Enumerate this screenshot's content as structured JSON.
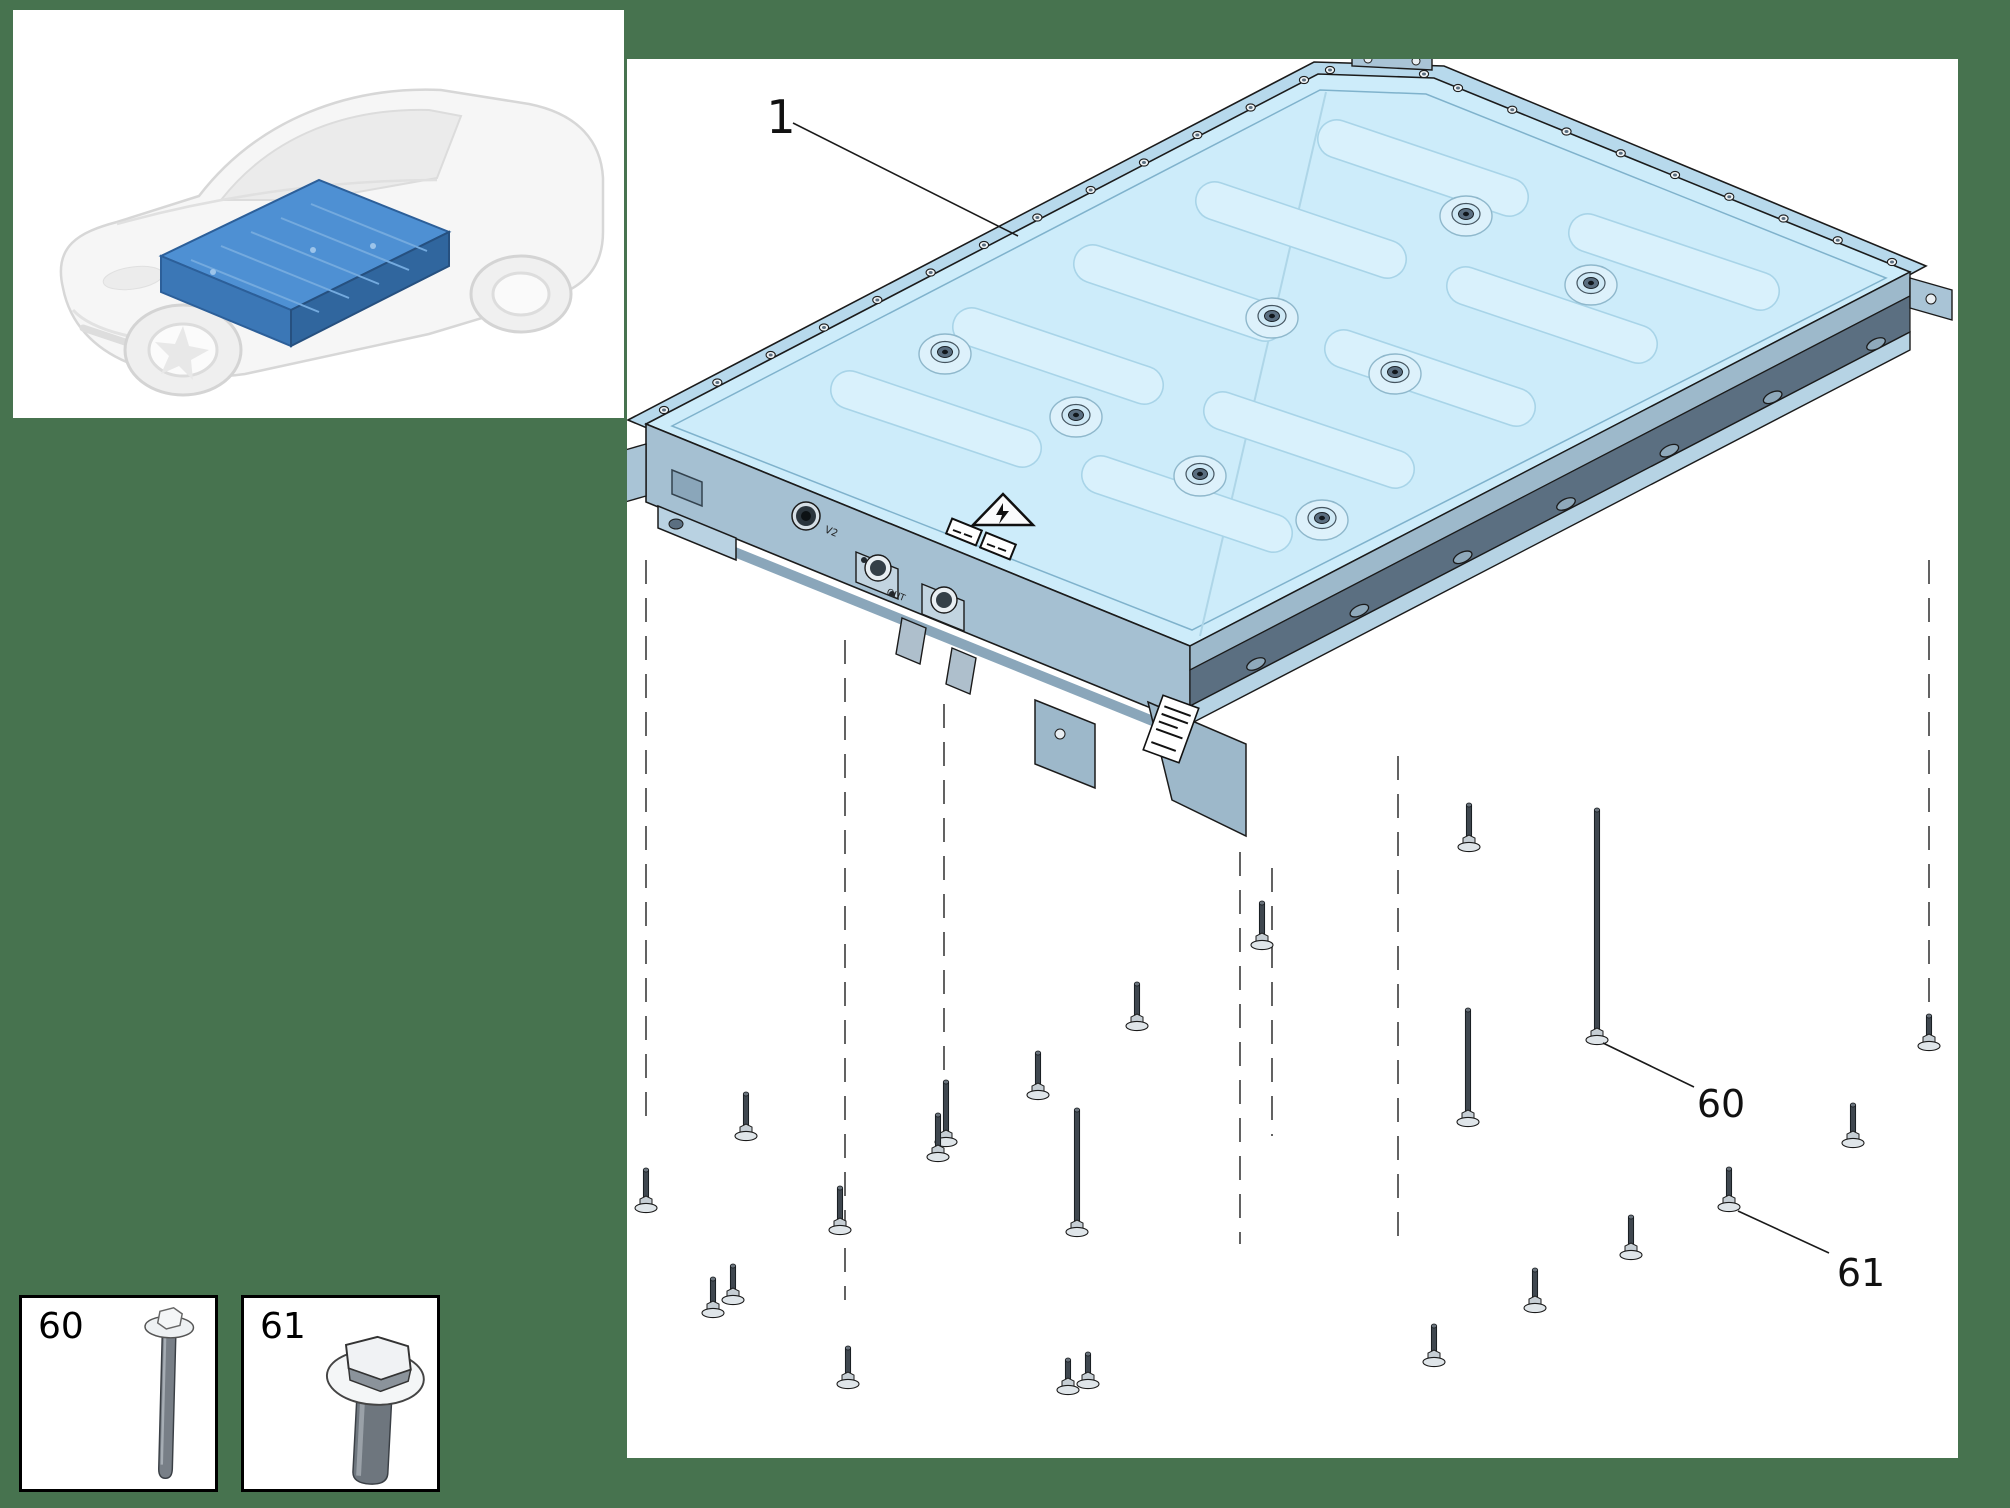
{
  "colors": {
    "background": "#47734f",
    "panel": "#ffffff",
    "pack_top": "#cdecfa",
    "pack_rim": "#b7d9ec",
    "pack_wall": "#a5c0d2",
    "pack_wall_right": "#9db9cb",
    "pack_dark_band": "#5b6f81",
    "pack_flange": "#b6d3e4",
    "outline": "#1b1b1b",
    "bolt_shaft": "#3f474f",
    "bolt_flange": "#dfe5e9",
    "dash": "#3c3c3c",
    "inset_battery_top": "#4e90d3",
    "inset_battery_left": "#3b77b6",
    "inset_battery_right": "#30669e",
    "car_line": "#d7d7d7",
    "car_fill": "#f6f6f6"
  },
  "inset": {
    "x": 13,
    "y": 10,
    "w": 611,
    "h": 408
  },
  "main_panel": {
    "x": 627,
    "y": 59,
    "w": 1331,
    "h": 1399
  },
  "pack_labels": {
    "port": "V2",
    "out": "OUT"
  },
  "callouts": [
    {
      "id": "1",
      "label": "1",
      "tx": 781,
      "ty": 133,
      "size": 46,
      "x1": 793,
      "y1": 123,
      "x2": 1018,
      "y2": 236
    },
    {
      "id": "60",
      "label": "60",
      "tx": 1721,
      "ty": 1117,
      "size": 38,
      "x1": 1603,
      "y1": 1043,
      "x2": 1694,
      "y2": 1087
    },
    {
      "id": "61",
      "label": "61",
      "tx": 1861,
      "ty": 1286,
      "size": 38,
      "x1": 1738,
      "y1": 1211,
      "x2": 1829,
      "y2": 1253
    }
  ],
  "dashed_lines": [
    {
      "x": 646,
      "y1": 560,
      "y2": 1120
    },
    {
      "x": 845,
      "y1": 640,
      "y2": 1300
    },
    {
      "x": 944,
      "y1": 704,
      "y2": 1082
    },
    {
      "x": 1240,
      "y1": 852,
      "y2": 1244
    },
    {
      "x": 1272,
      "y1": 868,
      "y2": 1136
    },
    {
      "x": 1398,
      "y1": 756,
      "y2": 1246
    },
    {
      "x": 1929,
      "y1": 560,
      "y2": 1034
    }
  ],
  "bolts": [
    {
      "x": 646,
      "y": 1208,
      "len": 38
    },
    {
      "x": 713,
      "y": 1313,
      "len": 34
    },
    {
      "x": 733,
      "y": 1300,
      "len": 34
    },
    {
      "x": 746,
      "y": 1136,
      "len": 42
    },
    {
      "x": 848,
      "y": 1384,
      "len": 36
    },
    {
      "x": 946,
      "y": 1142,
      "len": 60
    },
    {
      "x": 1077,
      "y": 1232,
      "len": 122
    },
    {
      "x": 1068,
      "y": 1390,
      "len": 30
    },
    {
      "x": 1088,
      "y": 1384,
      "len": 30
    },
    {
      "x": 1262,
      "y": 945,
      "len": 42
    },
    {
      "x": 1137,
      "y": 1026,
      "len": 42
    },
    {
      "x": 1038,
      "y": 1095,
      "len": 42
    },
    {
      "x": 938,
      "y": 1157,
      "len": 42
    },
    {
      "x": 840,
      "y": 1230,
      "len": 42
    },
    {
      "x": 1469,
      "y": 847,
      "len": 42
    },
    {
      "x": 1468,
      "y": 1122,
      "len": 112
    },
    {
      "x": 1597,
      "y": 1040,
      "len": 230
    },
    {
      "x": 1853,
      "y": 1143,
      "len": 38
    },
    {
      "x": 1729,
      "y": 1207,
      "len": 38
    },
    {
      "x": 1631,
      "y": 1255,
      "len": 38
    },
    {
      "x": 1535,
      "y": 1308,
      "len": 38
    },
    {
      "x": 1929,
      "y": 1046,
      "len": 30
    },
    {
      "x": 1434,
      "y": 1362,
      "len": 36
    }
  ],
  "pack": {
    "caps": [
      [
        1466,
        216
      ],
      [
        1591,
        285
      ],
      [
        1395,
        374
      ],
      [
        1272,
        318
      ],
      [
        945,
        354
      ],
      [
        1076,
        417
      ],
      [
        1200,
        476
      ],
      [
        1322,
        520
      ]
    ],
    "ribs": [
      [
        936,
        419
      ],
      [
        1187,
        504
      ],
      [
        1058,
        356
      ],
      [
        1309,
        440
      ],
      [
        1179,
        293
      ],
      [
        1430,
        378
      ],
      [
        1301,
        230
      ],
      [
        1552,
        315
      ],
      [
        1423,
        168
      ],
      [
        1674,
        262
      ]
    ],
    "rib_angle": 18.7,
    "rib_len": 220,
    "rib_w": 38,
    "screw_edges": [
      {
        "x1": 664,
        "y1": 410,
        "x2": 1304,
        "y2": 80,
        "n": 13
      },
      {
        "x1": 1330,
        "y1": 70,
        "x2": 1424,
        "y2": 74,
        "n": 2
      },
      {
        "x1": 1458,
        "y1": 88,
        "x2": 1892,
        "y2": 262,
        "n": 9
      },
      {
        "x1": 692,
        "y1": 452,
        "x2": 1162,
        "y2": 646,
        "n": 9
      }
    ],
    "flange_holes": {
      "x1": 1256,
      "y1": 664,
      "x2": 1876,
      "y2": 344,
      "n": 7,
      "angle": -26
    }
  },
  "legend": {
    "boxes": [
      {
        "label": "60",
        "x": 19,
        "y": 1295,
        "w": 199,
        "h": 197,
        "type": "long-bolt"
      },
      {
        "label": "61",
        "x": 241,
        "y": 1295,
        "w": 199,
        "h": 197,
        "type": "hex-flange-bolt"
      }
    ]
  }
}
